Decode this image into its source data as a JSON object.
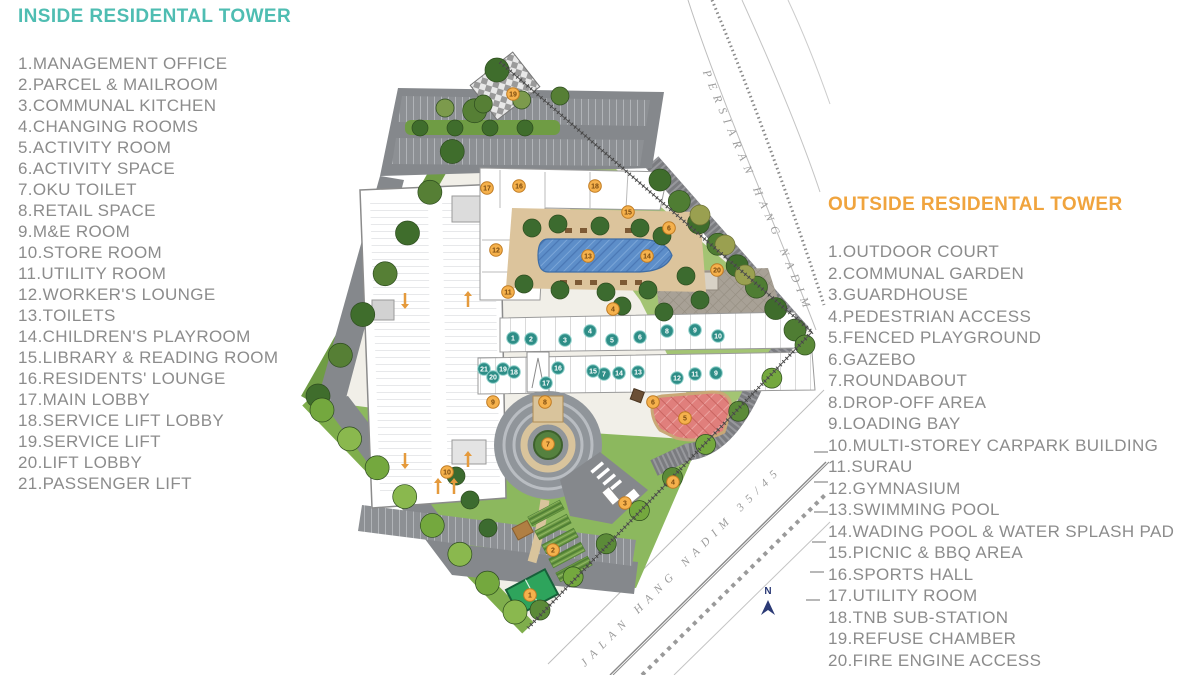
{
  "legend_inside": {
    "title": "INSIDE RESIDENTAL TOWER",
    "title_color": "#4fbdb2",
    "items": [
      "1.MANAGEMENT OFFICE",
      "2.PARCEL & MAILROOM",
      "3.COMMUNAL KITCHEN",
      "4.CHANGING ROOMS",
      "5.ACTIVITY ROOM",
      "6.ACTIVITY SPACE",
      "7.OKU TOILET",
      "8.RETAIL SPACE",
      "9.M&E ROOM",
      "10.STORE ROOM",
      "11.UTILITY ROOM",
      "12.WORKER'S LOUNGE",
      "13.TOILETS",
      "14.CHILDREN'S PLAYROOM",
      "15.LIBRARY & READING ROOM",
      "16.RESIDENTS' LOUNGE",
      "17.MAIN LOBBY",
      "18.SERVICE LIFT LOBBY",
      "19.SERVICE LIFT",
      "20.LIFT LOBBY",
      "21.PASSENGER LIFT"
    ]
  },
  "legend_outside": {
    "title": "OUTSIDE RESIDENTAL TOWER",
    "title_color": "#f0a43e",
    "items": [
      "1.OUTDOOR COURT",
      "2.COMMUNAL GARDEN",
      "3.GUARDHOUSE",
      "4.PEDESTRIAN ACCESS",
      "5.FENCED PLAYGROUND",
      "6.GAZEBO",
      "7.ROUNDABOUT",
      "8.DROP-OFF AREA",
      "9.LOADING BAY",
      "10.MULTI-STOREY CARPARK BUILDING",
      "11.SURAU",
      "12.GYMNASIUM",
      "13.SWIMMING POOL",
      "14.WADING POOL & WATER SPLASH PAD",
      "15.PICNIC & BBQ AREA",
      "16.SPORTS HALL",
      "17.UTILITY ROOM",
      "18.TNB SUB-STATION",
      "19.REFUSE CHAMBER",
      "20.FIRE ENGINE ACCESS"
    ]
  },
  "plan": {
    "road_top_label": "PERSIARAN HANG NADIM",
    "road_bottom_label": "JALAN HANG NADIM 35/45",
    "north_label": "N",
    "marker_inside_color": "#2e8e87",
    "marker_outside_color": "#f5b14c",
    "markers_inside": [
      {
        "n": "1",
        "x": 513,
        "y": 338
      },
      {
        "n": "2",
        "x": 531,
        "y": 339
      },
      {
        "n": "3",
        "x": 565,
        "y": 340
      },
      {
        "n": "4",
        "x": 590,
        "y": 331
      },
      {
        "n": "5",
        "x": 612,
        "y": 340
      },
      {
        "n": "6",
        "x": 640,
        "y": 337
      },
      {
        "n": "8",
        "x": 667,
        "y": 331
      },
      {
        "n": "9",
        "x": 695,
        "y": 330
      },
      {
        "n": "10",
        "x": 718,
        "y": 336
      },
      {
        "n": "21",
        "x": 484,
        "y": 369
      },
      {
        "n": "20",
        "x": 493,
        "y": 377
      },
      {
        "n": "19",
        "x": 503,
        "y": 369
      },
      {
        "n": "18",
        "x": 514,
        "y": 372
      },
      {
        "n": "17",
        "x": 546,
        "y": 383
      },
      {
        "n": "16",
        "x": 558,
        "y": 368
      },
      {
        "n": "7",
        "x": 604,
        "y": 374
      },
      {
        "n": "15",
        "x": 593,
        "y": 371
      },
      {
        "n": "14",
        "x": 619,
        "y": 373
      },
      {
        "n": "13",
        "x": 638,
        "y": 372
      },
      {
        "n": "12",
        "x": 677,
        "y": 378
      },
      {
        "n": "11",
        "x": 695,
        "y": 374
      },
      {
        "n": "9",
        "x": 716,
        "y": 373
      }
    ],
    "markers_outside": [
      {
        "n": "1",
        "x": 530,
        "y": 595
      },
      {
        "n": "2",
        "x": 553,
        "y": 550
      },
      {
        "n": "3",
        "x": 625,
        "y": 503
      },
      {
        "n": "4",
        "x": 673,
        "y": 482
      },
      {
        "n": "4",
        "x": 613,
        "y": 309
      },
      {
        "n": "5",
        "x": 685,
        "y": 418
      },
      {
        "n": "6",
        "x": 653,
        "y": 402
      },
      {
        "n": "6",
        "x": 669,
        "y": 228
      },
      {
        "n": "7",
        "x": 548,
        "y": 444
      },
      {
        "n": "8",
        "x": 545,
        "y": 402
      },
      {
        "n": "9",
        "x": 493,
        "y": 402
      },
      {
        "n": "10",
        "x": 447,
        "y": 472
      },
      {
        "n": "11",
        "x": 508,
        "y": 292
      },
      {
        "n": "12",
        "x": 496,
        "y": 250
      },
      {
        "n": "13",
        "x": 588,
        "y": 256
      },
      {
        "n": "14",
        "x": 647,
        "y": 256
      },
      {
        "n": "15",
        "x": 628,
        "y": 212
      },
      {
        "n": "16",
        "x": 519,
        "y": 186
      },
      {
        "n": "17",
        "x": 487,
        "y": 188
      },
      {
        "n": "18",
        "x": 595,
        "y": 186
      },
      {
        "n": "19",
        "x": 513,
        "y": 94
      },
      {
        "n": "20",
        "x": 717,
        "y": 270
      }
    ]
  }
}
